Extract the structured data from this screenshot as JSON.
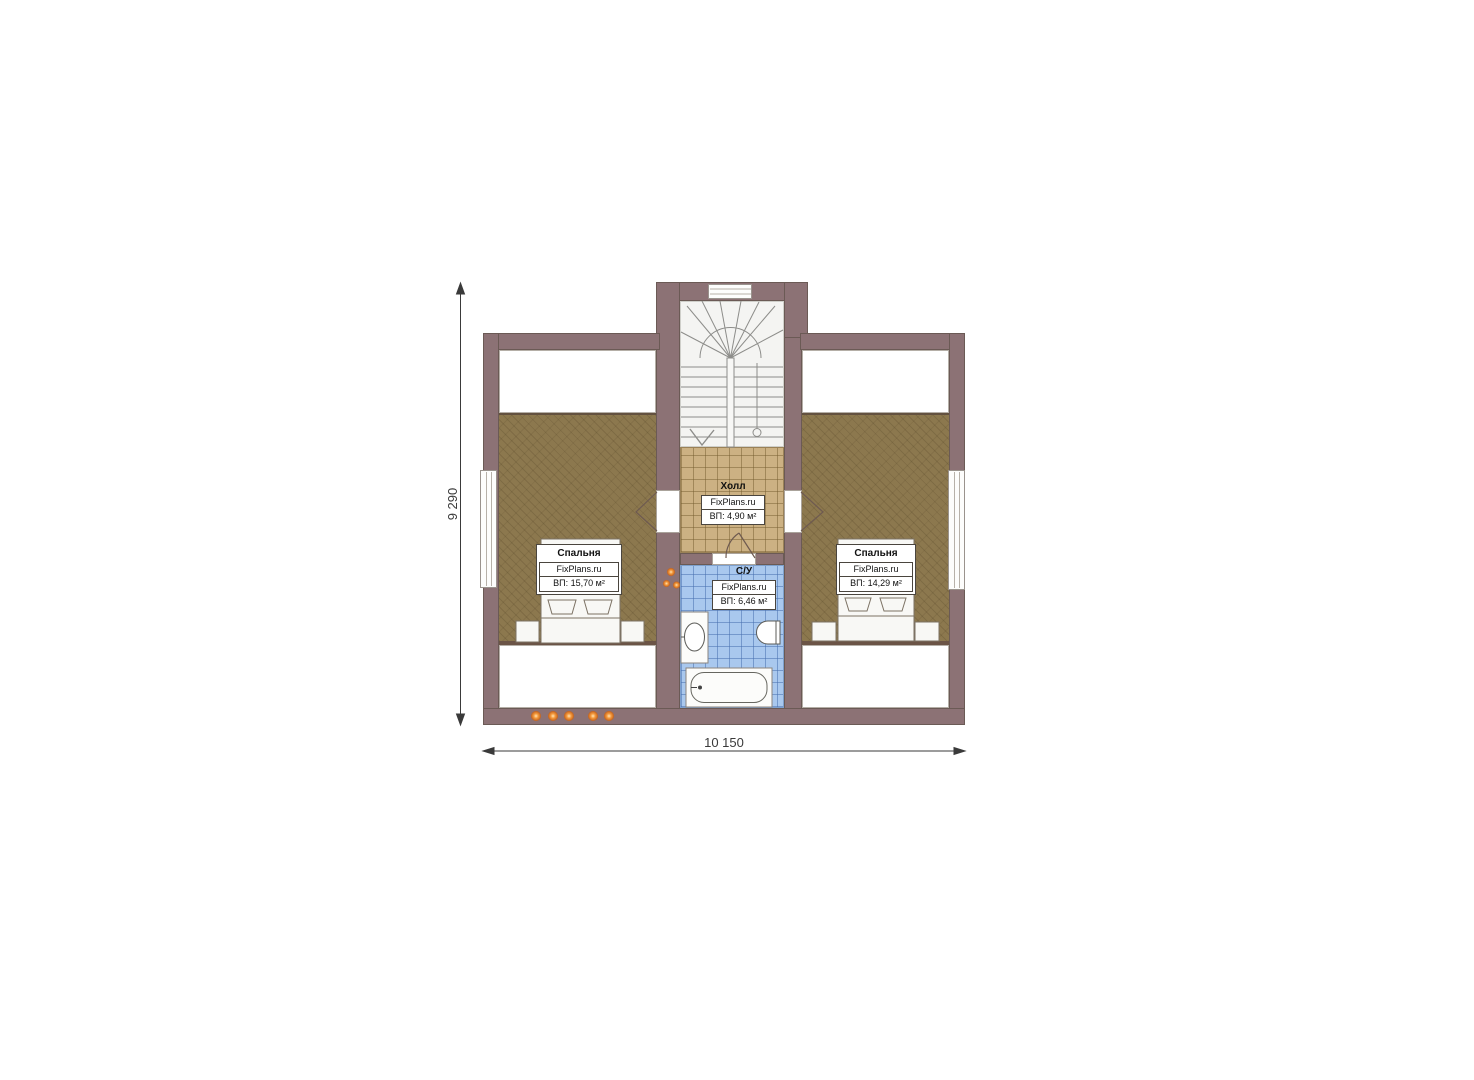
{
  "plan": {
    "rooms": {
      "bedroom_left": {
        "name": "Спальня",
        "brand": "FixPlans.ru",
        "area": "ВП: 15,70 м²"
      },
      "bedroom_right": {
        "name": "Спальня",
        "brand": "FixPlans.ru",
        "area": "ВП: 14,29 м²"
      },
      "hall": {
        "name": "Холл",
        "brand": "FixPlans.ru",
        "area": "ВП: 4,90 м²"
      },
      "bathroom": {
        "name": "С/У",
        "brand": "FixPlans.ru",
        "area": "ВП: 6,46 м²"
      }
    },
    "dimensions": {
      "width": "10 150",
      "height": "9 290"
    },
    "colors": {
      "wall": "#8c7275",
      "carpet": "#8c784e",
      "hall_tile": "#ccb183",
      "bath_tile": "#a9c8ee",
      "light_dot": "#f59b3c",
      "background": "#ffffff"
    }
  }
}
